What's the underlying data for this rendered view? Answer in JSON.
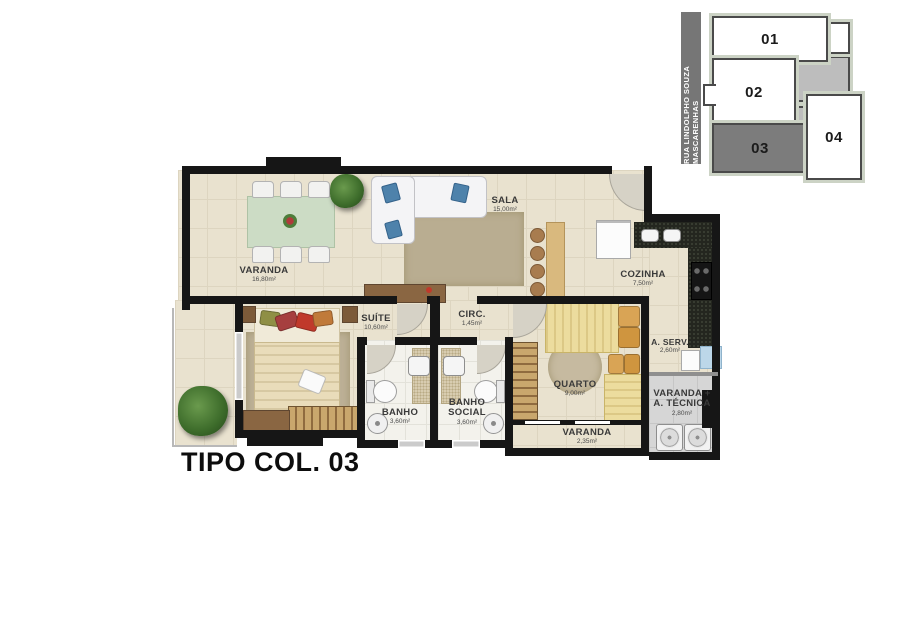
{
  "title": "TIPO COL. 03",
  "key_plan": {
    "street_label": "RUA LINDOLPHO SOUZA MASCARENHAS",
    "highlighted_unit": "03",
    "units": [
      {
        "label": "01"
      },
      {
        "label": "02"
      },
      {
        "label": "03"
      },
      {
        "label": "04"
      }
    ]
  },
  "rooms": [
    {
      "name": "VARANDA",
      "area": "16,80m²"
    },
    {
      "name": "SALA",
      "area": "15,00m²"
    },
    {
      "name": "COZINHA",
      "area": "7,50m²"
    },
    {
      "name": "A. SERV.",
      "area": "2,60m²"
    },
    {
      "name": "SUÍTE",
      "area": "10,60m²"
    },
    {
      "name": "CIRC.",
      "area": "1,45m²"
    },
    {
      "name": "BANHO",
      "area": "3,60m²"
    },
    {
      "name": "BANHO SOCIAL",
      "area": "3,60m²"
    },
    {
      "name": "QUARTO",
      "area": "9,00m²"
    },
    {
      "name": "VARANDA",
      "area": "2,35m²"
    },
    {
      "name": "VARANDA + A. TÉCNICA",
      "area": "2,80m²"
    }
  ],
  "palette": {
    "floor_beige": "#e9e2cf",
    "floor_bath": "#f3f2ec",
    "floor_technical": "#d6d6d6",
    "wall": "#161616",
    "granite_counter": "#24261f",
    "keyplan_highlight": "#7c7c7c",
    "keyplan_common": "#bdbdbd",
    "keyplan_outline": "#ccd3c5",
    "wood": "#8a6642",
    "sofa_cushion": "#4e82ab"
  }
}
